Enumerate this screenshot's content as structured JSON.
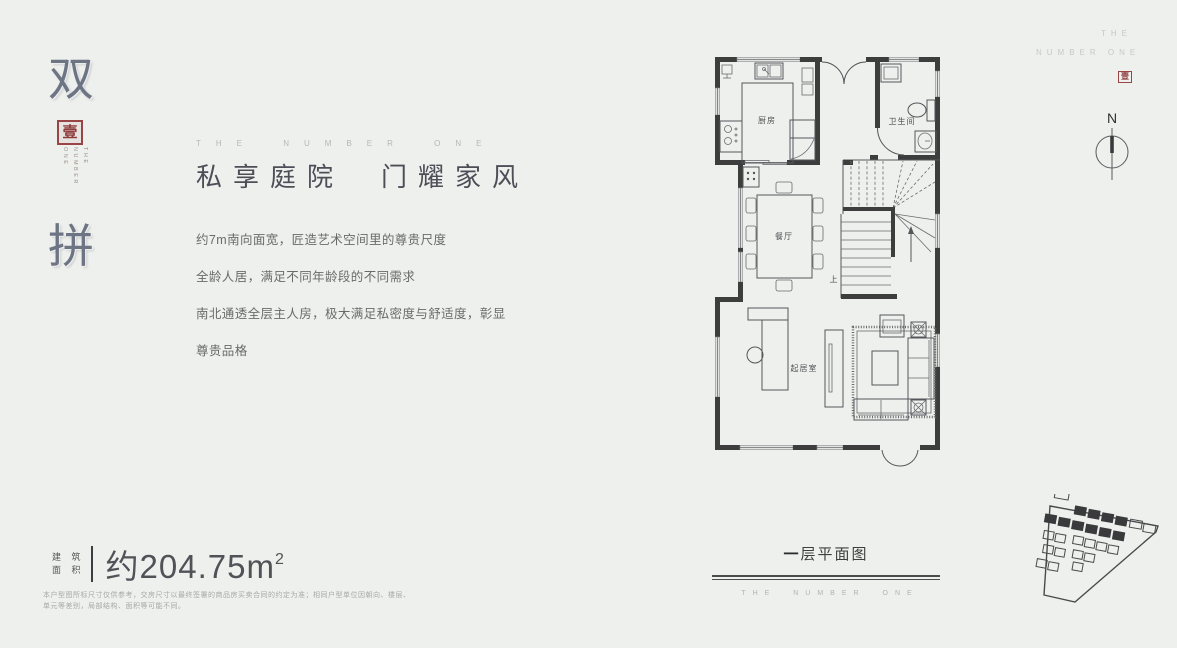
{
  "colors": {
    "background": "#eef0ed",
    "wall": "#3d3d3e",
    "accent_red": "#8e3b3d",
    "title_text": "#4d4f58",
    "body_text": "#6a6a6a",
    "muted_brand": "#b7b7b2"
  },
  "left_panel": {
    "hero_char_top": "双",
    "hero_char_bottom": "拼",
    "seal_char": "壹",
    "vertical_brand_line1": "THE",
    "vertical_brand_line2": "NUMBER ONE"
  },
  "main": {
    "eyebrow": "THE NUMBER ONE",
    "headline": "私享庭院　门耀家风",
    "body_lines": [
      "约7m南向面宽，匠造艺术空间里的尊贵尺度",
      "全龄人居，满足不同年龄段的不同需求",
      "南北通透全层主人房，极大满足私密度与舒适度，彰显",
      "尊贵品格"
    ]
  },
  "area": {
    "label_top": "建 筑",
    "label_bottom": "面 积",
    "value": "约204.75m",
    "value_sup": "2"
  },
  "disclaimer": {
    "line1": "本户型图所标尺寸仅供参考，交房尺寸以最终签署的商品房买卖合同的约定为准；相同户型单位因朝向、楼层、",
    "line2": "单元等差别，局部结构、面积等可能不同。"
  },
  "floorplan": {
    "rooms": {
      "kitchen": "厨房",
      "bathroom": "卫生间",
      "dining": "餐厅",
      "living": "起居室",
      "stairs_up": "上"
    },
    "caption_bold": "一",
    "caption_rest": "层平面图",
    "footer_brand": "THE NUMBER ONE"
  },
  "top_right": {
    "brand_line1": "THE",
    "brand_line2": "NUMBER ONE",
    "seal_char": "壹",
    "compass_label": "N"
  }
}
